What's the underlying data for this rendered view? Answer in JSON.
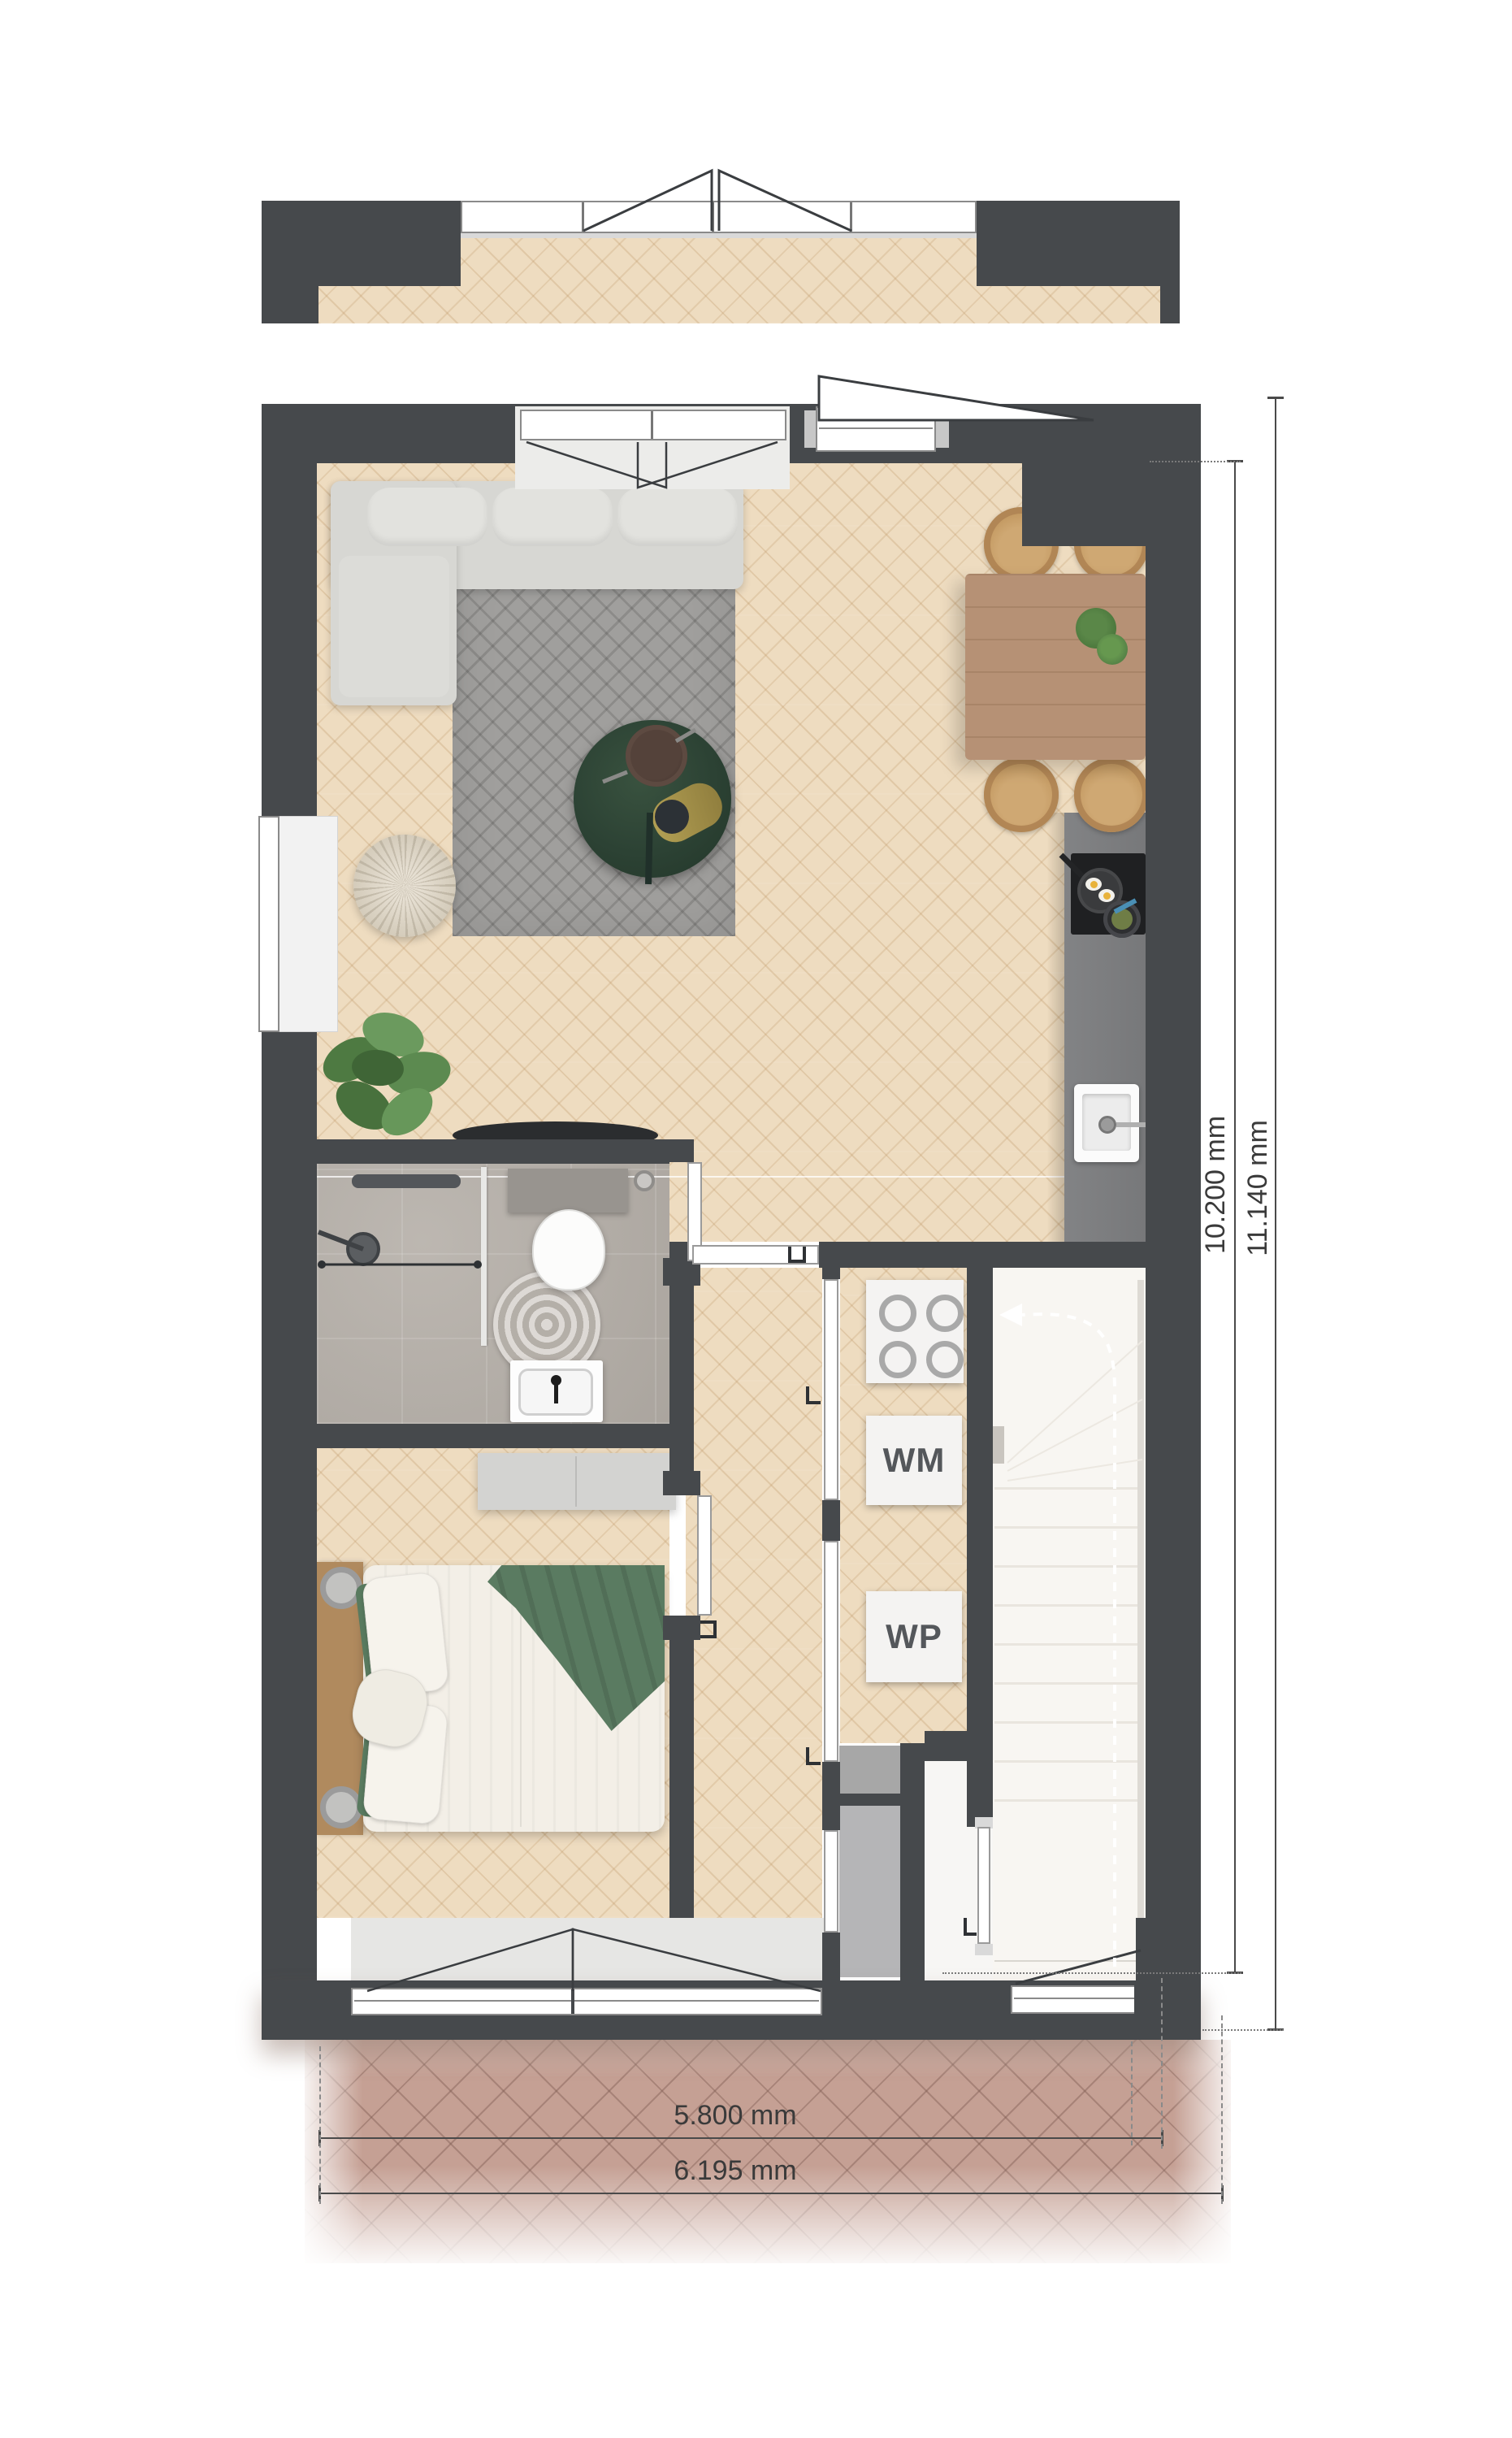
{
  "labels": {
    "washing_machine": "WM",
    "heat_pump": "WP"
  },
  "dimensions": {
    "inner_height": "10.200 mm",
    "outer_height": "11.140 mm",
    "inner_width": "5.800 mm",
    "outer_width": "6.195 mm"
  },
  "colors": {
    "wall": "#46494c",
    "wood_floor": "#eedcc0",
    "bathroom_tile": "#b5afa8",
    "kitchen_counter": "#7b7c7e",
    "stairs_floor": "#f8f6f2",
    "paving_brick": "#c5a094",
    "sofa": "#d7d7d3",
    "rug": "#a09f9d",
    "coffee_table_green": "#2c4234",
    "dining_table_wood": "#b69175",
    "chair_wood": "#cfa873",
    "bed_blanket_green": "#5a7b61",
    "appliance_box": "#f4f3f2",
    "appliance_label_text": "#54575b",
    "dimension_text": "#3a3a3a"
  }
}
